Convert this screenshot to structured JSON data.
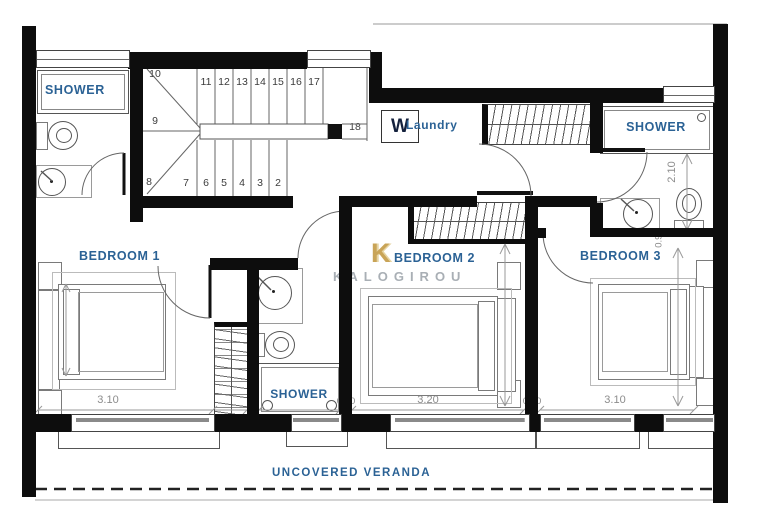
{
  "rooms": {
    "shower_top_left": "SHOWER",
    "shower_top_right": "SHOWER",
    "shower_middle": "SHOWER",
    "laundry_label": "Laundry",
    "washer_letter": "W",
    "bedroom1": "BEDROOM 1",
    "bedroom2": "BEDROOM 2",
    "bedroom3": "BEDROOM 3",
    "veranda": "UNCOVERED VERANDA"
  },
  "logo": {
    "initial": "K",
    "name": "KALOGIROU"
  },
  "dims": {
    "br1_depth": "3.70",
    "br1_width": "3.10",
    "closet_width": "0.60",
    "br2_width": "3.20",
    "br2_depth": "3.10",
    "br3_width": "3.10",
    "br3_depth": "3.20",
    "shower_right_depth": "2.10",
    "door_right": "0.90",
    "wall_gap_left": "0.30",
    "wall_gap_right": "0.30"
  },
  "stairs": {
    "up_run": [
      "11",
      "12",
      "13",
      "14",
      "15",
      "16",
      "17"
    ],
    "top_step": "18",
    "winders": [
      "10",
      "9",
      "8"
    ],
    "down_run": [
      "7",
      "6",
      "5",
      "4",
      "3",
      "2"
    ]
  },
  "colors": {
    "label_blue": "#2b6295",
    "dim_gray": "#8c8c8c",
    "logo_gold": "#c9a457",
    "logo_gray": "#a9afb5",
    "wall_black": "#0d0d0d"
  }
}
